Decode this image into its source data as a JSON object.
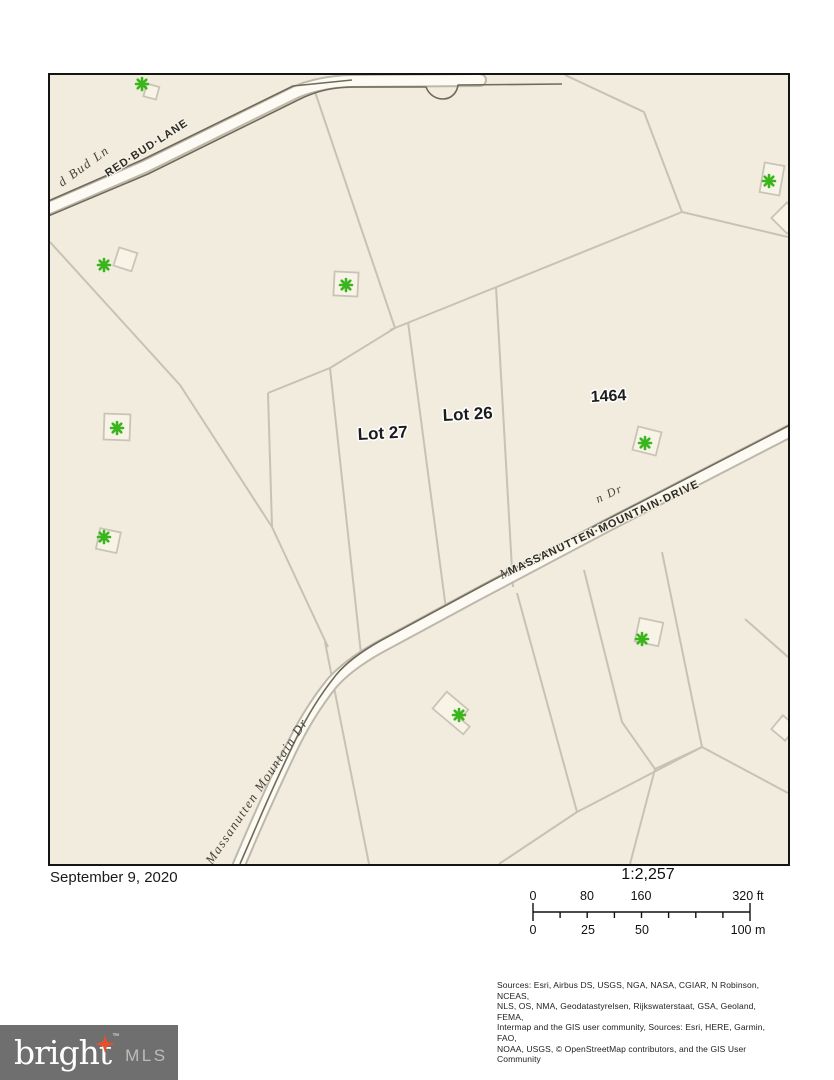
{
  "map": {
    "background_color": "#f1ecdd",
    "marker_color": "#3bb51d",
    "road_labels": {
      "red_bud_lane": "RED·BUD·LANE",
      "red_bud_ln_serif": "d Bud Ln",
      "massanutten_drive": "MASSANUTTEN·MOUNTAIN·DRIVE",
      "massanutten_serif_overlap": "Massau",
      "massanutten_serif_fragment": "n Dr",
      "massanutten_mountain_dr_serif": "Massanutten Mountain Dr"
    },
    "parcel_labels": {
      "lot27": "Lot 27",
      "lot26": "Lot 26",
      "parcel_1464": "1464"
    }
  },
  "footer": {
    "date": "September 9, 2020",
    "scale_ratio": "1:2,257",
    "scalebar": {
      "ft": [
        "0",
        "80",
        "160",
        "320 ft"
      ],
      "m": [
        "0",
        "25",
        "50",
        "100 m"
      ]
    },
    "sources_lines": [
      "Sources: Esri, Airbus DS, USGS, NGA, NASA, CGIAR, N Robinson, NCEAS,",
      "NLS, OS, NMA, Geodatastyrelsen, Rijkswaterstaat, GSA, Geoland, FEMA,",
      "Intermap and the GIS user community, Sources: Esri, HERE, Garmin, FAO,",
      "NOAA, USGS, © OpenStreetMap contributors, and the GIS User Community"
    ]
  },
  "logo": {
    "brand": "bright",
    "trademark": "™",
    "suffix": "MLS"
  }
}
